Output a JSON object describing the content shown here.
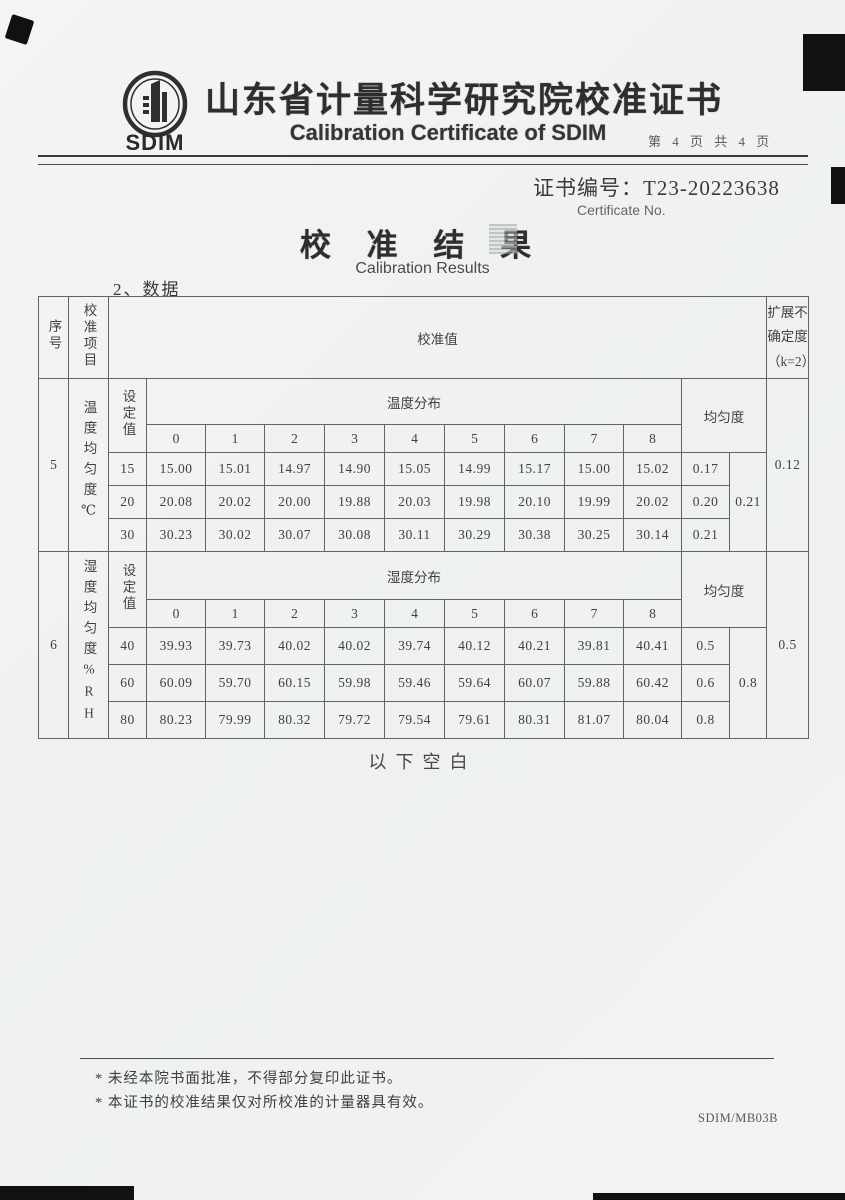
{
  "header": {
    "logo_text": "SDIM",
    "title_cn": "山东省计量科学研究院校准证书",
    "title_en": "Calibration Certificate of SDIM",
    "page_info": "第 4 页 共 4 页",
    "cert_no_label": "证书编号：",
    "cert_no_value": "T23-20223638",
    "cert_no_en": "Certificate No."
  },
  "body": {
    "result_title_cn": "校 准 结 果",
    "result_title_en": "Calibration Results",
    "data_heading": "2、数据",
    "below_blank": "以下空白"
  },
  "table": {
    "corner_headers": {
      "seq": "序号",
      "item": "校准项目",
      "value": "校准值",
      "uncertainty": "扩展不确定度\n（k=2）"
    },
    "sections": [
      {
        "seq": "5",
        "item": "温度均匀度℃",
        "set_label": "设定值",
        "dist_label": "温度分布",
        "uniformity_label": "均匀度",
        "positions": [
          "0",
          "1",
          "2",
          "3",
          "4",
          "5",
          "6",
          "7",
          "8"
        ],
        "rows": [
          {
            "set": "15",
            "values": [
              "15.00",
              "15.01",
              "14.97",
              "14.90",
              "15.05",
              "14.99",
              "15.17",
              "15.00",
              "15.02"
            ],
            "uniformity": "0.17"
          },
          {
            "set": "20",
            "values": [
              "20.08",
              "20.02",
              "20.00",
              "19.88",
              "20.03",
              "19.98",
              "20.10",
              "19.99",
              "20.02"
            ],
            "uniformity": "0.20"
          },
          {
            "set": "30",
            "values": [
              "30.23",
              "30.02",
              "30.07",
              "30.08",
              "30.11",
              "30.29",
              "30.38",
              "30.25",
              "30.14"
            ],
            "uniformity": "0.21"
          }
        ],
        "overall_uniformity": "0.21",
        "uncertainty": "0.12"
      },
      {
        "seq": "6",
        "item": "湿度均匀度%RH",
        "set_label": "设定值",
        "dist_label": "湿度分布",
        "uniformity_label": "均匀度",
        "positions": [
          "0",
          "1",
          "2",
          "3",
          "4",
          "5",
          "6",
          "7",
          "8"
        ],
        "rows": [
          {
            "set": "40",
            "values": [
              "39.93",
              "39.73",
              "40.02",
              "40.02",
              "39.74",
              "40.12",
              "40.21",
              "39.81",
              "40.41"
            ],
            "uniformity": "0.5"
          },
          {
            "set": "60",
            "values": [
              "60.09",
              "59.70",
              "60.15",
              "59.98",
              "59.46",
              "59.64",
              "60.07",
              "59.88",
              "60.42"
            ],
            "uniformity": "0.6"
          },
          {
            "set": "80",
            "values": [
              "80.23",
              "79.99",
              "80.32",
              "79.72",
              "79.54",
              "79.61",
              "80.31",
              "81.07",
              "80.04"
            ],
            "uniformity": "0.8"
          }
        ],
        "overall_uniformity": "0.8",
        "uncertainty": "0.5"
      }
    ]
  },
  "footer": {
    "notes": [
      "* 未经本院书面批准，不得部分复印此证书。",
      "* 本证书的校准结果仅对所校准的计量器具有效。"
    ],
    "form_code": "SDIM/MB03B"
  }
}
